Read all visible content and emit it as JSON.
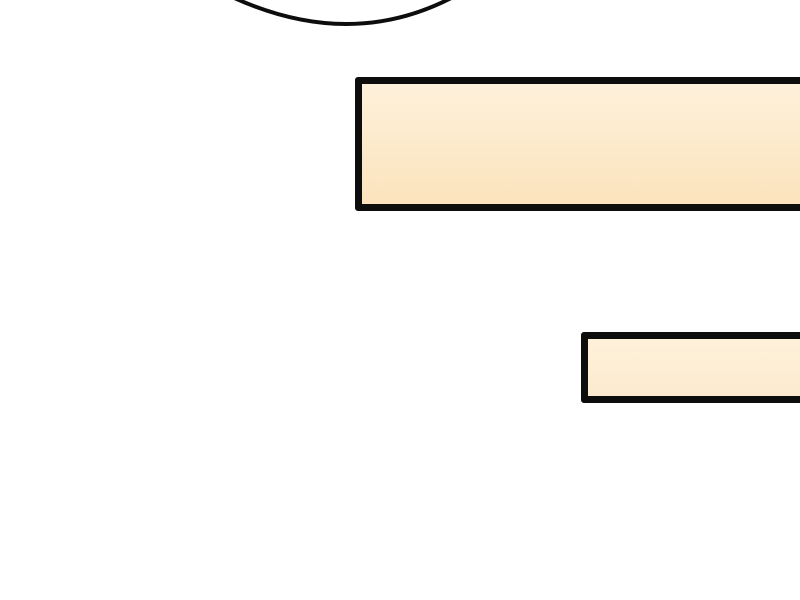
{
  "colors": {
    "background": "#ffffff",
    "outline": "#0d0d0d",
    "box_fill_top": "#fef1da",
    "box_fill_bottom": "#fbe3bd",
    "box_small_fill_bottom": "#fcead0"
  },
  "panel": {
    "speech_balloon": {
      "text": "",
      "note": "only the bottom arc of the balloon is visible, clipped at the top edge"
    },
    "caption_box_large": {
      "text": ""
    },
    "caption_box_small": {
      "text": ""
    }
  }
}
